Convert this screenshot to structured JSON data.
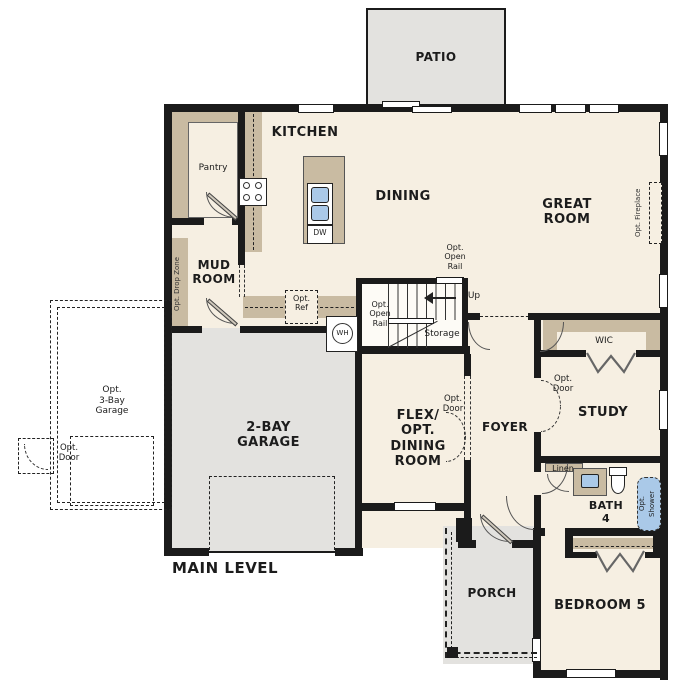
{
  "plan_title": "MAIN LEVEL",
  "colors": {
    "floor": "#f6efe2",
    "concrete": "#e3e2df",
    "casework_tan": "#c9bba2",
    "wall_black": "#1b1b1b",
    "fixture_blue": "#aac9e8"
  },
  "rooms": {
    "patio": "PATIO",
    "kitchen": "KITCHEN",
    "dining": "DINING",
    "great_room": "GREAT\nROOM",
    "pantry": "Pantry",
    "mud_room": "MUD\nROOM",
    "garage": "2-BAY\nGARAGE",
    "flex": "FLEX/\nOPT. DINING\nROOM",
    "foyer": "FOYER",
    "study": "STUDY",
    "wic": "WIC",
    "bath": "BATH\n4",
    "bedroom": "BEDROOM 5",
    "porch": "PORCH",
    "storage": "Storage",
    "linen": "Linen"
  },
  "annotations": {
    "opt_drop_zone": "Opt. Drop Zone",
    "opt_ref": "Opt.\nRef",
    "opt_open_rail_top": "Opt.\nOpen\nRail",
    "opt_open_rail_left": "Opt.\nOpen\nRail",
    "up": "Up",
    "opt_fireplace": "Opt. Fireplace",
    "opt_3bay_garage": "Opt.\n3-Bay\nGarage",
    "opt_door_garage": "Opt.\nDoor",
    "opt_door_flex": "Opt.\nDoor",
    "opt_door_study": "Opt.\nDoor",
    "opt_shower": "Opt.\nShower",
    "dishwasher": "DW",
    "water_heater": "WH"
  }
}
